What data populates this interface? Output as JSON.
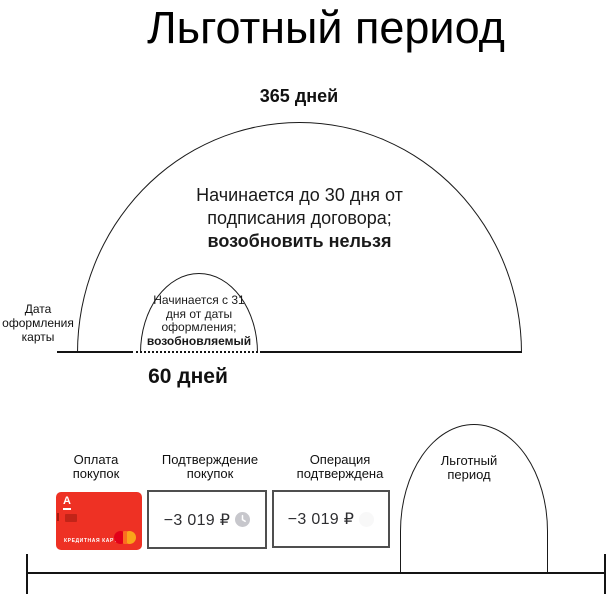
{
  "title": "Льготный период",
  "top_diagram": {
    "outer_label": "365 дней",
    "outer_arc_text": "Начинается  до 30 дня от\nподписания договора;",
    "outer_arc_text_bold": "возобновить нельзя",
    "inner_arc_text": "Начинается с 31\nдня от даты\nоформления;",
    "inner_arc_text_bold": "возобновляемый",
    "left_label": "Дата\nоформления\nкарты",
    "inner_label": "60 дней"
  },
  "timeline": {
    "steps": [
      {
        "label": "Оплата\nпокупок"
      },
      {
        "label": "Подтверждение\nпокупок",
        "amount": "−3 019 ₽",
        "icon": "clock-icon"
      },
      {
        "label": "Операция\nподтверждена",
        "amount": "−3 019 ₽"
      }
    ],
    "arch_label": "Льготный\nпериод",
    "card": {
      "bank_logo": "А",
      "card_type": "КРЕДИТНАЯ КАРТА",
      "brand_icon": "mastercard-icon",
      "color": "#ee3124"
    }
  },
  "colors": {
    "line": "#141414",
    "card_red": "#ee3124",
    "mastercard_red": "#e2001a",
    "mastercard_orange": "#f9a51a",
    "clock_gray": "#c7c7cc",
    "box_border": "#4f4f4f"
  }
}
